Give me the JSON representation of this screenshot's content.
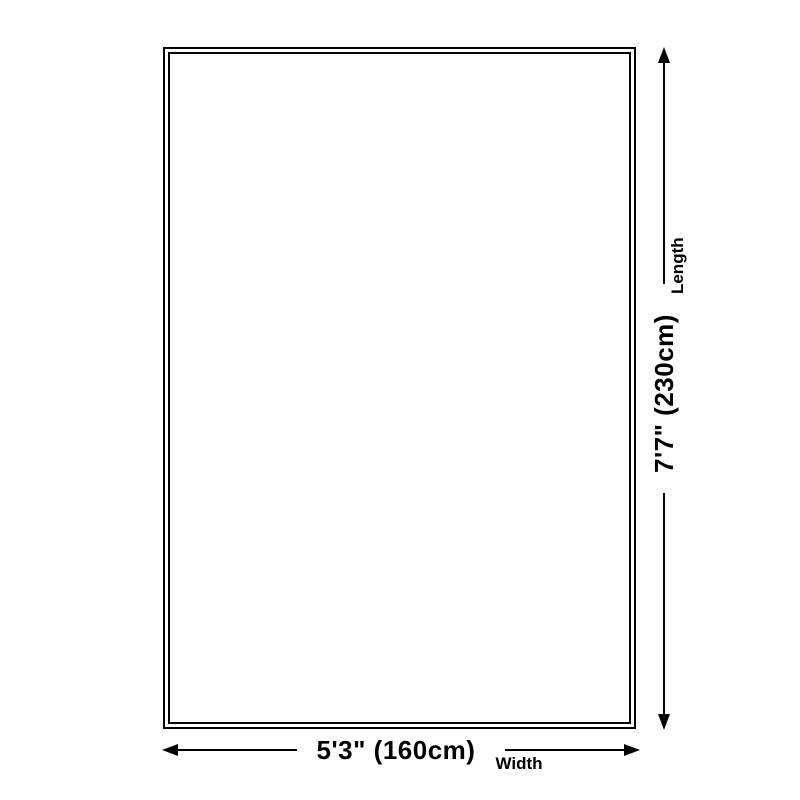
{
  "diagram": {
    "colors": {
      "stroke": "#000000",
      "background": "#ffffff"
    },
    "width": {
      "value": "5'3\" (160cm)",
      "label": "Width"
    },
    "length": {
      "value": "7'7\" (230cm)",
      "label": "Length"
    }
  }
}
